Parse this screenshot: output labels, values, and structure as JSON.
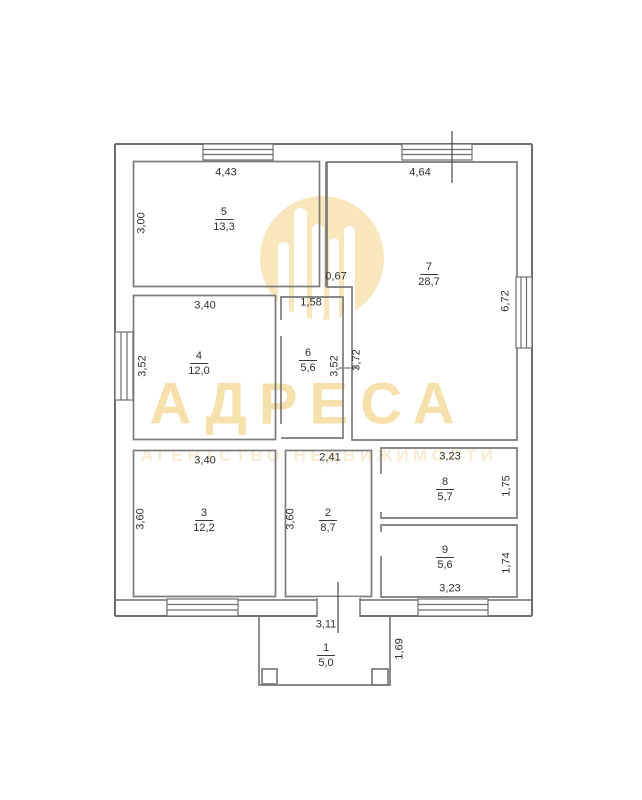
{
  "watermark": {
    "title": "АДРЕСА",
    "subtitle": "АГЕНТСТВО НЕДВИЖИМОСТИ",
    "brand_color": "#f6e0ac",
    "subtitle_color": "#f8ecd4",
    "logo": "building-skyline-in-circle-icon"
  },
  "plan": {
    "line_color": "#767676",
    "text_color": "#2f2f2f",
    "rooms": [
      {
        "number": "1",
        "area": "5,0"
      },
      {
        "number": "2",
        "area": "8,7"
      },
      {
        "number": "3",
        "area": "12,2"
      },
      {
        "number": "4",
        "area": "12,0"
      },
      {
        "number": "5",
        "area": "13,3"
      },
      {
        "number": "6",
        "area": "5,6"
      },
      {
        "number": "7",
        "area": "28,7"
      },
      {
        "number": "8",
        "area": "5,7"
      },
      {
        "number": "9",
        "area": "5,6"
      }
    ],
    "dimensions": {
      "room5_width": "4,43",
      "room7_width": "4,64",
      "room5_height": "3,00",
      "wall_jog": "0,67",
      "room6_width": "1,58",
      "room7_height": "6,72",
      "room4_width": "3,40",
      "room4_height": "3,52",
      "room6_height": "3,52",
      "room7_inner_height": "3,72",
      "room3_width": "3,40",
      "room2_width": "2,41",
      "room8_width": "3,23",
      "room3_height": "3,60",
      "room2_height": "3,60",
      "room8_height": "1,75",
      "room9_height": "1,74",
      "room9_width": "3,23",
      "porch_width": "3,11",
      "porch_height": "1,69"
    }
  }
}
